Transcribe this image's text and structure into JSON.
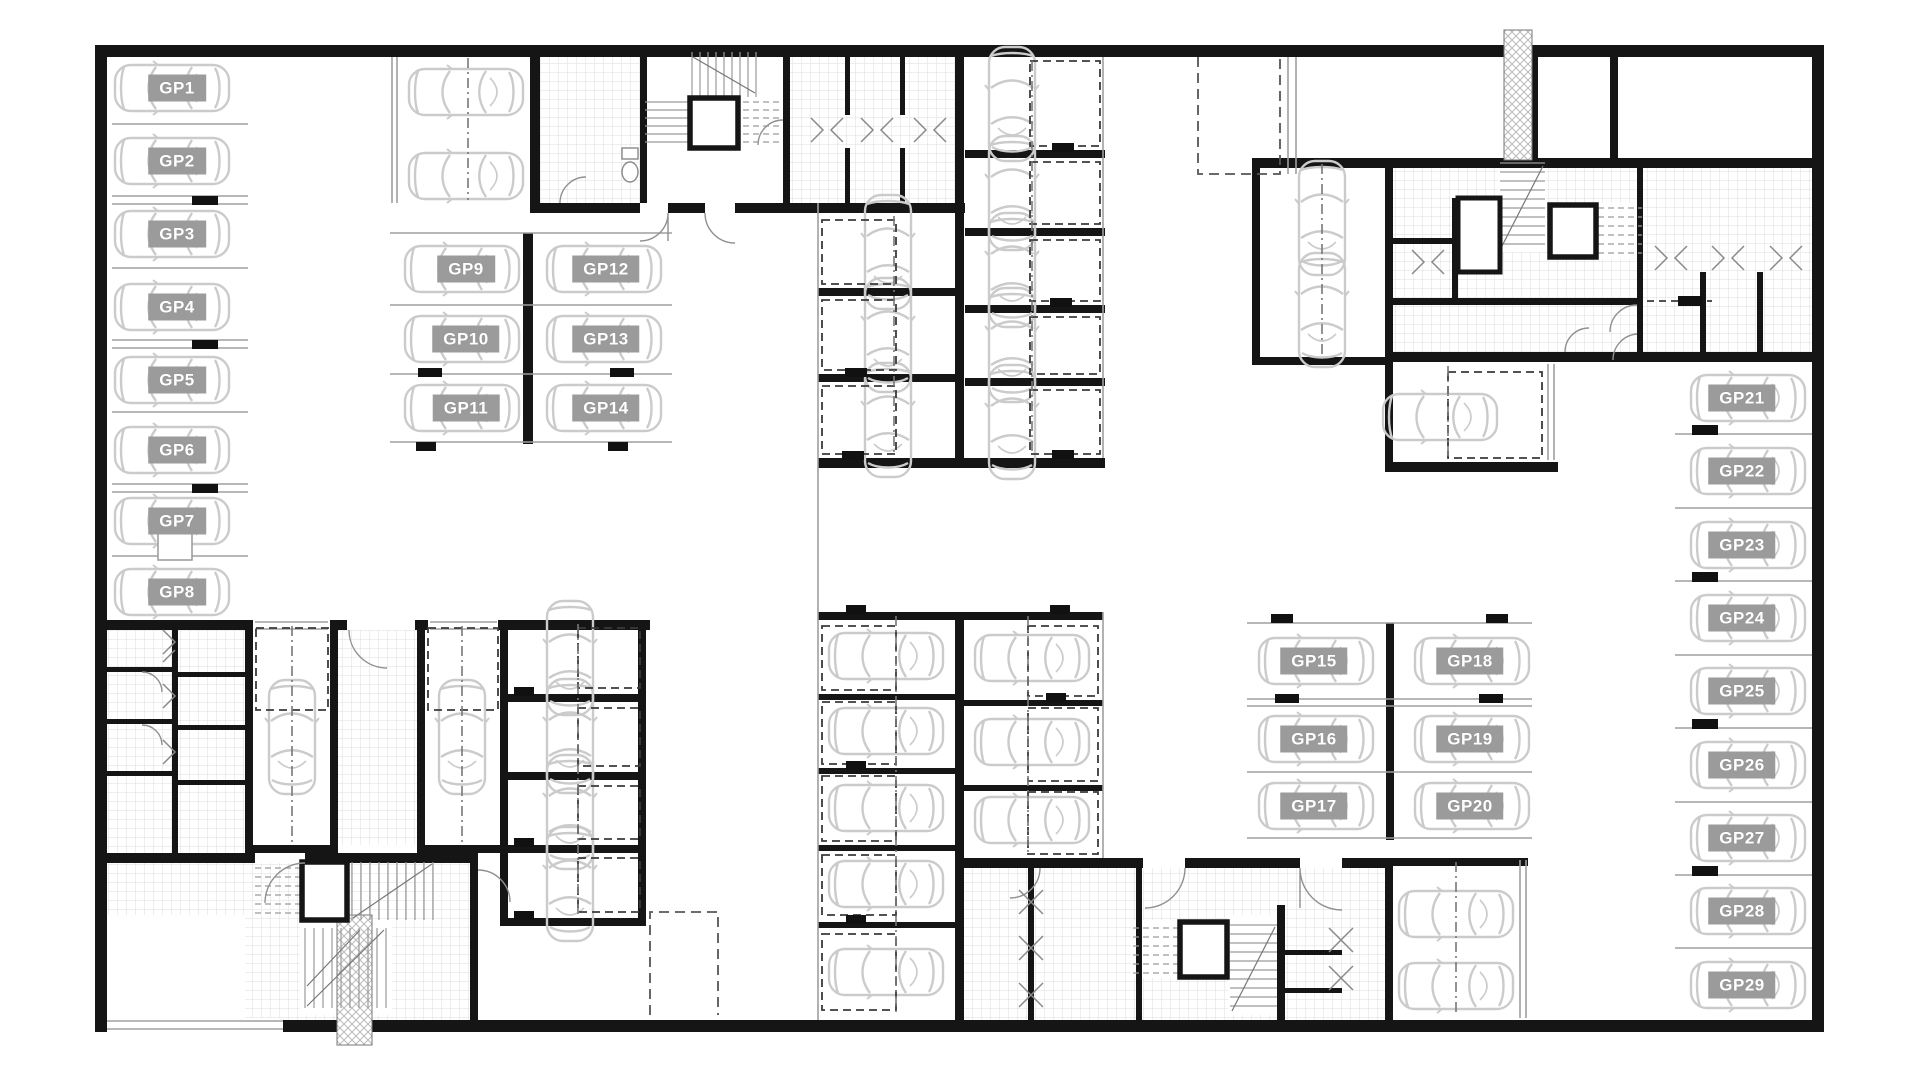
{
  "plan": {
    "type": "underground-parking-floor-plan",
    "colors": {
      "wall": "#151515",
      "spot_label_background": "#9b9b9b",
      "spot_label_text": "#ffffff",
      "car_outline": "#cccccc",
      "hatch_line": "#dedede",
      "stall_line": "#9f9f9f"
    },
    "icons": [
      "car-top-view-icon",
      "elevator-shaft-icon",
      "stair-flight-icon",
      "door-swing-icon",
      "double-door-chevron-icon",
      "toilet-icon",
      "ramp-crosshatch-icon",
      "wheel-stop-icon"
    ],
    "parking_spots": [
      {
        "label": "GP1"
      },
      {
        "label": "GP2"
      },
      {
        "label": "GP3"
      },
      {
        "label": "GP4"
      },
      {
        "label": "GP5"
      },
      {
        "label": "GP6"
      },
      {
        "label": "GP7"
      },
      {
        "label": "GP8"
      },
      {
        "label": "GP9"
      },
      {
        "label": "GP10"
      },
      {
        "label": "GP11"
      },
      {
        "label": "GP12"
      },
      {
        "label": "GP13"
      },
      {
        "label": "GP14"
      },
      {
        "label": "GP15"
      },
      {
        "label": "GP16"
      },
      {
        "label": "GP17"
      },
      {
        "label": "GP18"
      },
      {
        "label": "GP19"
      },
      {
        "label": "GP20"
      },
      {
        "label": "GP21"
      },
      {
        "label": "GP22"
      },
      {
        "label": "GP23"
      },
      {
        "label": "GP24"
      },
      {
        "label": "GP25"
      },
      {
        "label": "GP26"
      },
      {
        "label": "GP27"
      },
      {
        "label": "GP28"
      },
      {
        "label": "GP29"
      }
    ]
  }
}
